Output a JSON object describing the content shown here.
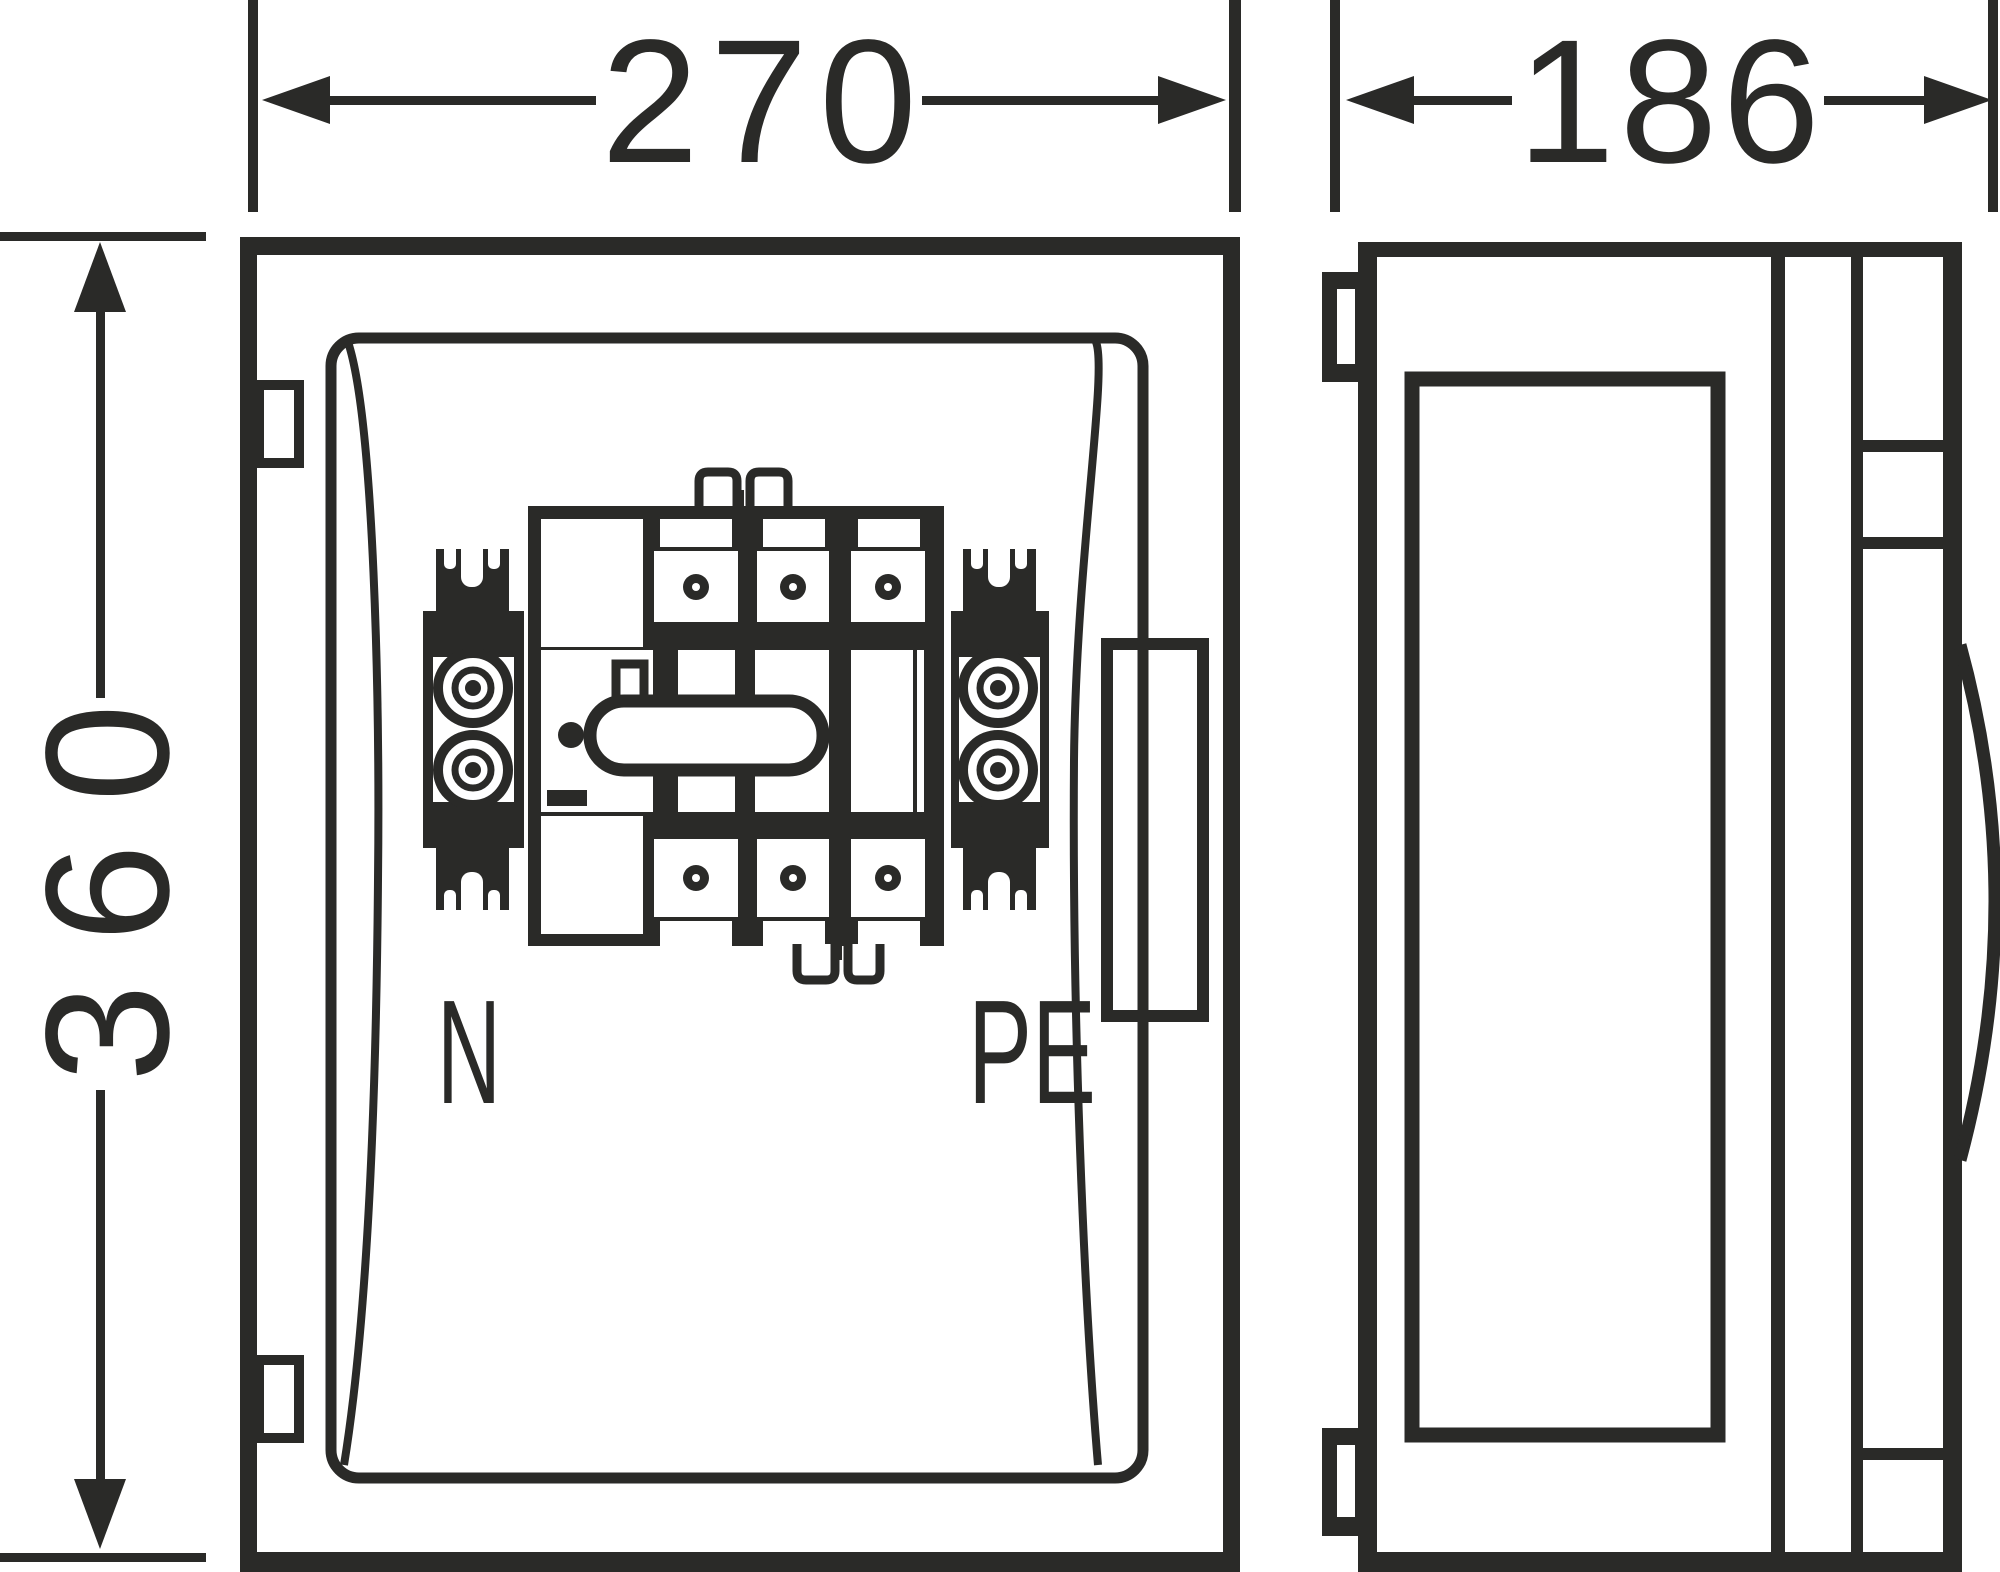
{
  "dimensions": {
    "width": {
      "value": "270"
    },
    "height": {
      "value": "360"
    },
    "depth": {
      "value": "186"
    }
  },
  "front_view": {
    "terminal_labels": {
      "neutral": "N",
      "earth": "PE"
    }
  },
  "colors": {
    "line": "#2a2a28",
    "background": "#ffffff"
  }
}
